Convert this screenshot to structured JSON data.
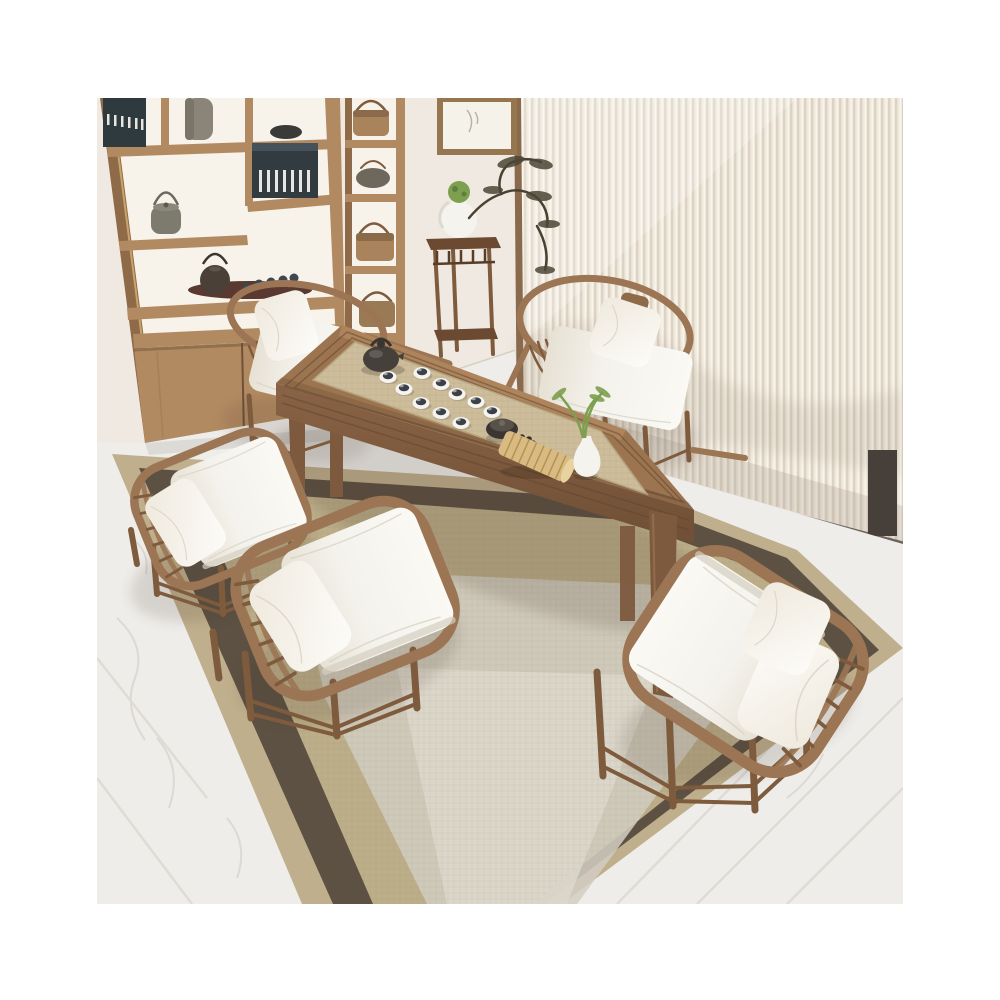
{
  "scene": {
    "description": "Top-down interior photograph of a new Chinese style walnut tea table set: a long rectangular tea table with a woven rattan inlay top holding a dark clay teapot, ten white teacups, a stone tea caddy, a dark bead bracelet, a rolled bamboo scroll and a small white bud vase with green leaves; five wooden armchairs with white cushions surround the table; behind are a wooden display bookshelf with tea ware and books, a framed artwork, a tall plant stand with a white porcelain vase and bonsai branches, and a cream vertical-slat screen; the set stands on a layered tan rug with a dark brown border over white marble flooring, centered on a white page background.",
    "photo_frame": "square product photo centered with white margins",
    "counts": {
      "chairs_total": 5,
      "round_back_armchairs": 2,
      "square_frame_armchairs": 3,
      "teacups_on_table": 10,
      "shelf_kettles": 4,
      "book_sets": 2
    },
    "objects": [
      {
        "name": "bookshelf",
        "label": "wooden display shelf with books, kettles and tea tray"
      },
      {
        "name": "side-shelf",
        "label": "narrow display column with kettle boxes"
      },
      {
        "name": "artwork",
        "label": "wood-framed artwork on wall"
      },
      {
        "name": "plant-stand",
        "label": "tall dark wood plant stand with porcelain vase"
      },
      {
        "name": "bonsai",
        "label": "bonsai branches"
      },
      {
        "name": "slat-screen",
        "label": "cream vertical slat screen"
      },
      {
        "name": "tea-table",
        "label": "long wooden tea table with rattan inlay"
      },
      {
        "name": "tea-set",
        "label": "teapot, teacups, caddy, beads, bamboo scroll, bud vase"
      },
      {
        "name": "area-rug",
        "label": "tan rug with dark brown border"
      },
      {
        "name": "marble-floor",
        "label": "white marble floor with gray veins"
      }
    ]
  },
  "palette": {
    "canvas_bg": "#ffffff",
    "wall": "#efe9e1",
    "shelf_wood": "#b28a62",
    "shelf_wood_dark": "#8f6a48",
    "shelf_panel": "#f7f2ea",
    "book_spine": "#2e3a3d",
    "screen_base": "#f0e9dd",
    "screen_line": "#d8cfc0",
    "screen_trim": "#8a6a4c",
    "art_frame": "#96764f",
    "art_paper": "#f5f2e9",
    "stand_wood": "#6b4a31",
    "porcelain": "#f5f3ee",
    "plant_green": "#7ca04f",
    "bonsai_branch": "#4a4032",
    "marble": "#efedea",
    "marble_vein": "#d8d4cf",
    "rug_outer": "#bfaf8d",
    "rug_dark": "#5d5144",
    "rug_inner": "#bcae89",
    "rug_light": "#d2cec3",
    "rug_lighter": "#ddd8cc",
    "table_wood": "#9c7450",
    "table_wood_light": "#c59a6c",
    "apron_wood": "#815c3e",
    "leg_wood": "#7d5a3e",
    "groove": "#5f4530",
    "mat": "#cdbd9b",
    "mat_line": "#b3a37e",
    "chair_wood": "#9b7554",
    "chair_wood_dark": "#7e5b3d",
    "cushion": "#f4f2ed",
    "cushion_shade": "#d4cec0",
    "teapot_dark": "#46403b",
    "cup_white": "#f6f4f0",
    "cup_dark": "#3c4148",
    "bamboo": "#d9ba82",
    "bamboo_line": "#b3934f",
    "shadow": "#3f3221"
  }
}
